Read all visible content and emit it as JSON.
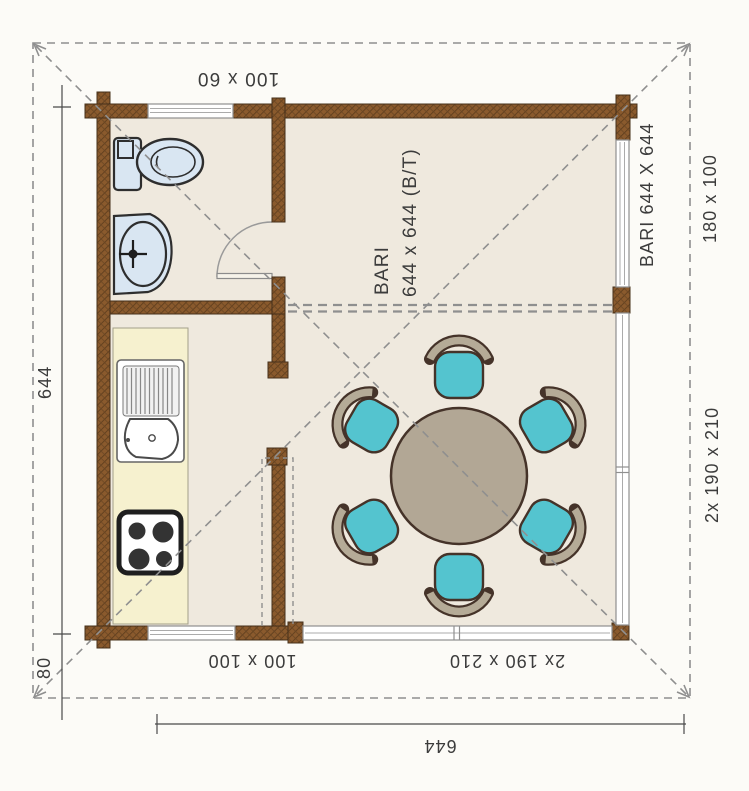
{
  "plan": {
    "model_label": {
      "line1": "BARI",
      "line2": "644 x 644 (B/T)"
    },
    "side_model_label": "BARI 644 X 644",
    "dimensions": {
      "top_window": "100 x 60",
      "right_window": "180 x 100",
      "right_door": "2x 190 x 210",
      "bottom_window": "100 x 100",
      "bottom_door": "2x 190 x 210",
      "total_width": "644",
      "total_depth": "644",
      "roof_overhang": "80"
    },
    "colors": {
      "background": "#fcfbf7",
      "floor": "#efe9de",
      "kitchen_counter": "#f6f1cf",
      "wall_brown": "#8a5a2d",
      "wall_hatch": "#5e3d1d",
      "wall_outline": "#46301a",
      "fixture_blue": "#d9e6f2",
      "chair_seat_teal": "#54c4cf",
      "chair_back_tan": "#b5ab97",
      "table_taupe": "#b2a795",
      "furniture_outline": "#453329",
      "glazing_white": "#ffffff",
      "frame_gray": "#8f8f8f",
      "dash_gray": "#8f8f8f",
      "dimension_gray": "#4a4a4a",
      "label_text": "#3c3c3c"
    }
  }
}
